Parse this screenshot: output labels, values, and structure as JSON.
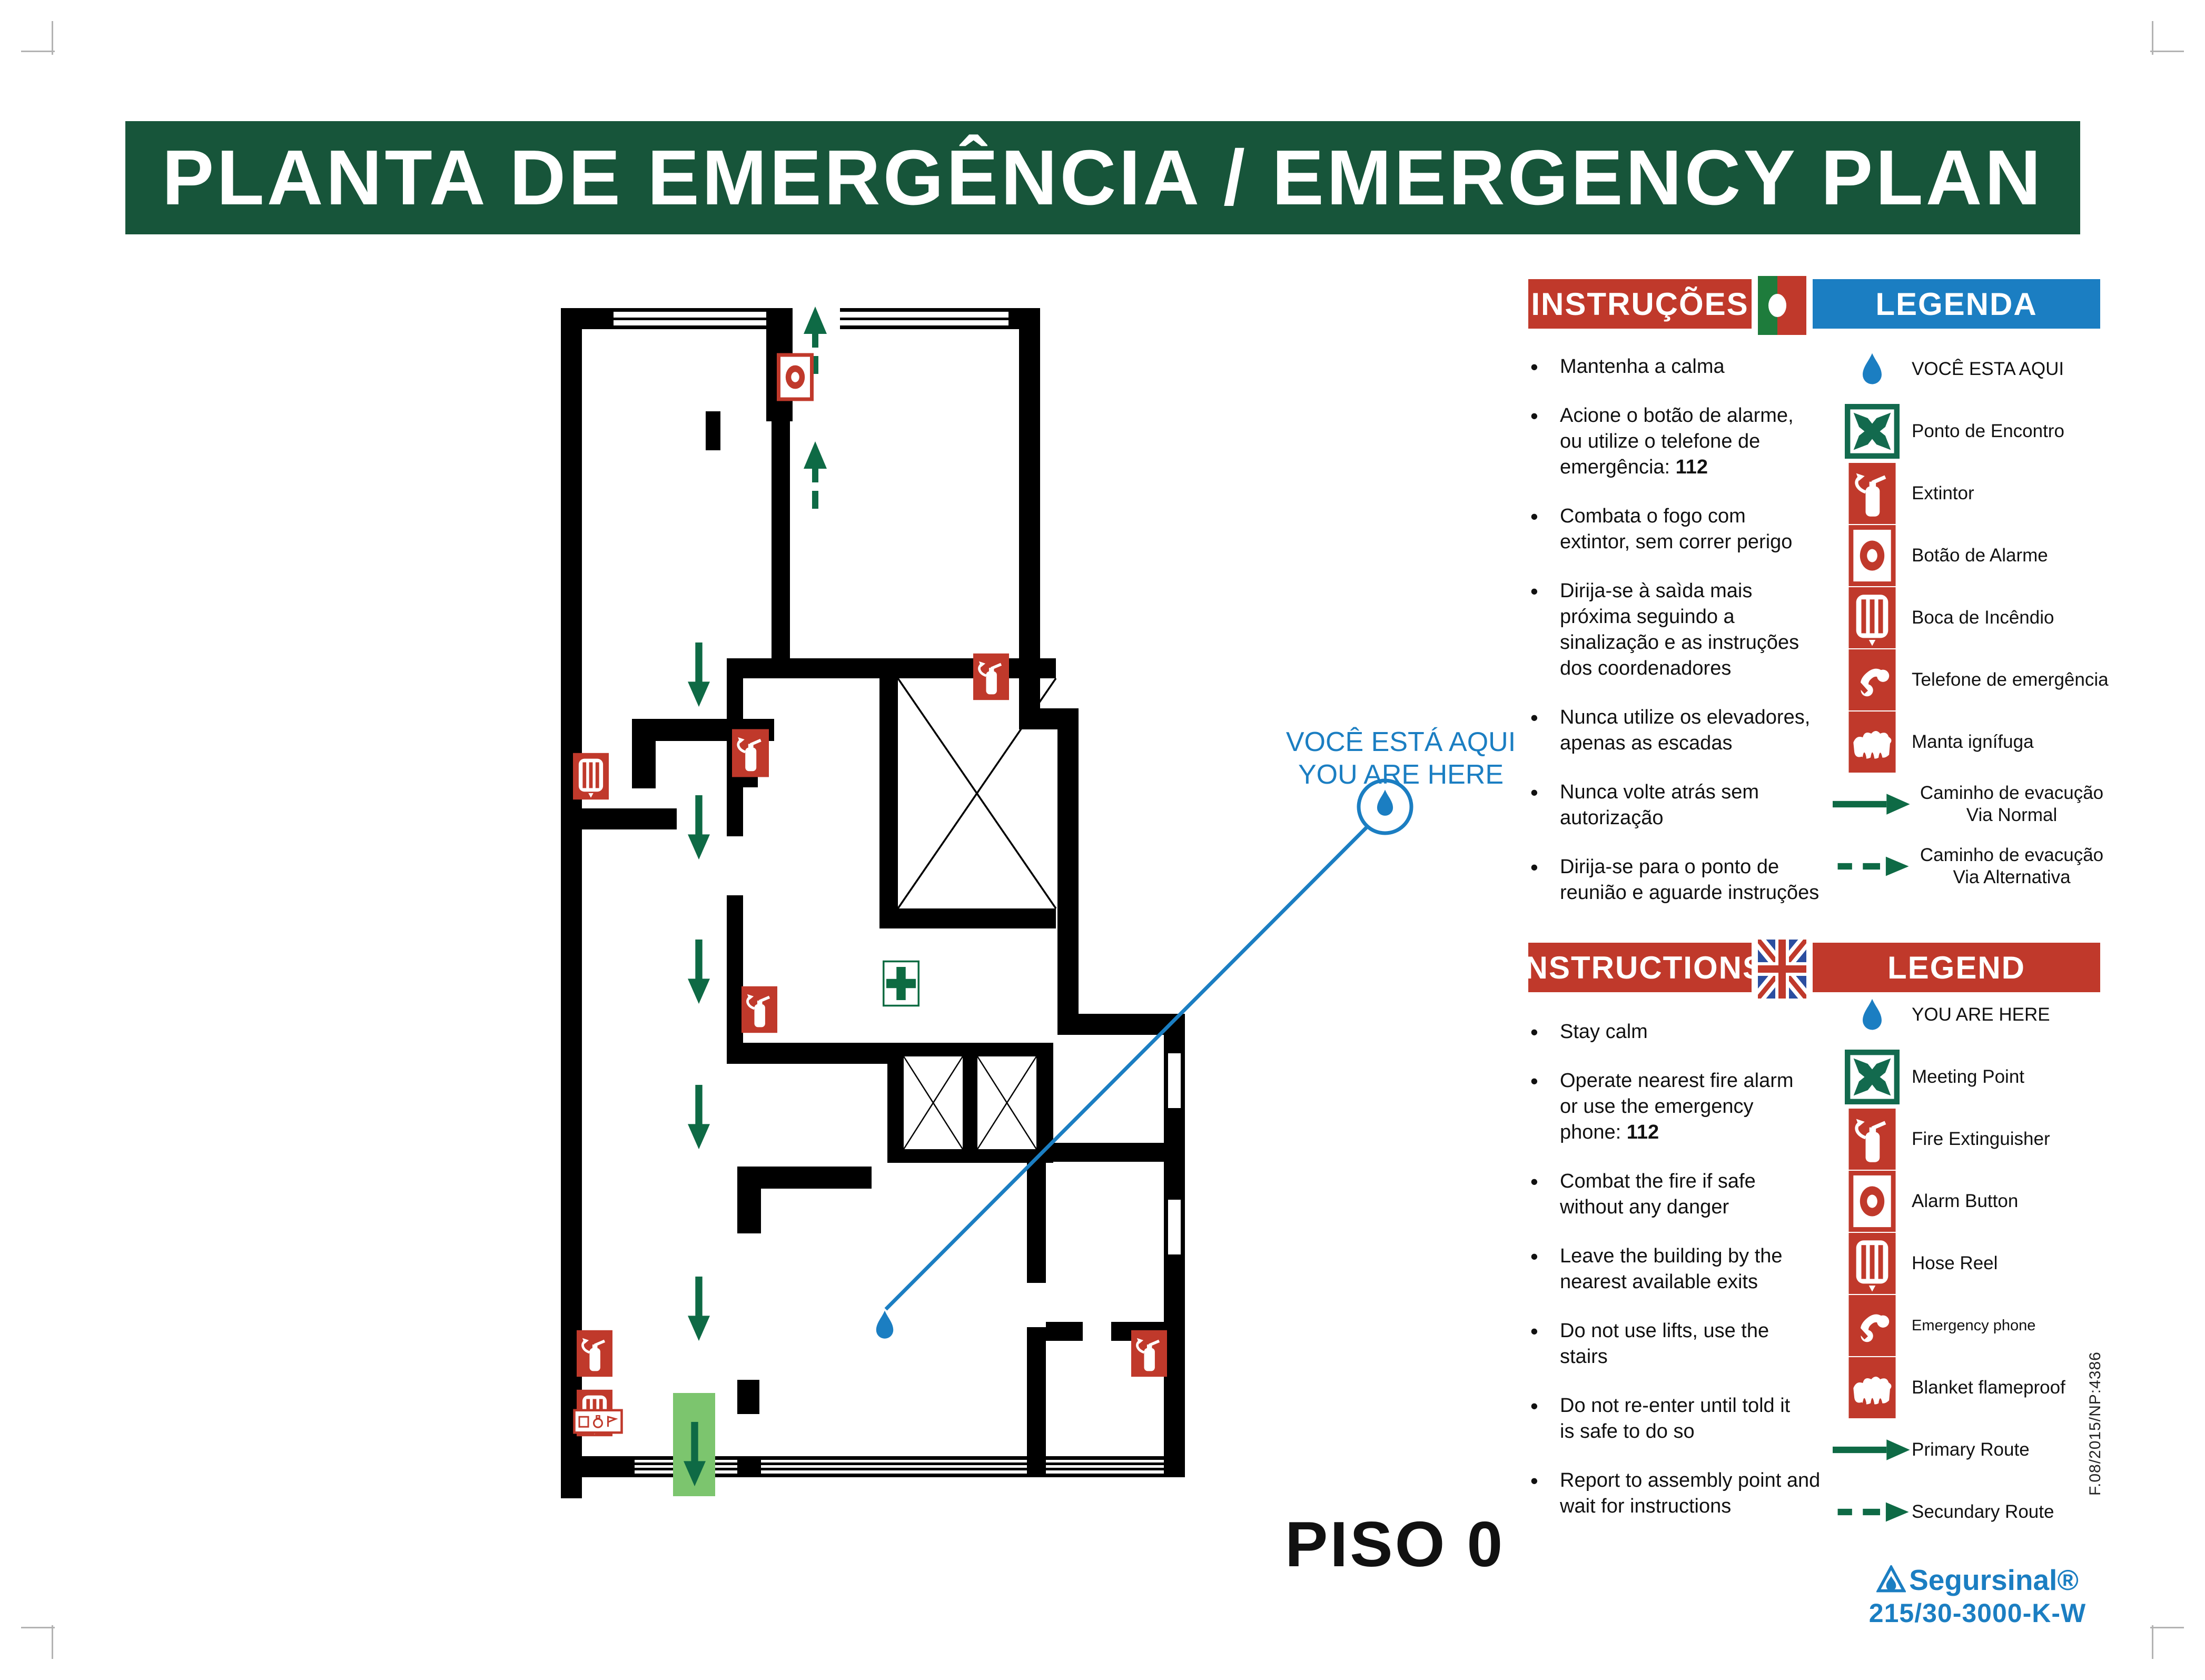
{
  "title": "PLANTA DE EMERGÊNCIA / EMERGENCY PLAN",
  "floor_label": "PISO 0",
  "emergency_number": "112",
  "callout": {
    "line1": "VOCÊ ESTÁ AQUI",
    "line2": "YOU ARE HERE"
  },
  "sections": {
    "pt": {
      "instructions_header": "INSTRUÇÕES",
      "legend_header": "LEGENDA",
      "flag": "portugal-flag",
      "instructions": [
        {
          "lines": [
            "Mantenha a calma"
          ]
        },
        {
          "lines": [
            "Acione o botão de alarme,",
            "ou utilize o telefone de",
            "emergência: 112"
          ]
        },
        {
          "lines": [
            "Combata o fogo com",
            "extintor, sem correr perigo"
          ]
        },
        {
          "lines": [
            "Dirija-se à saìda mais",
            "próxima seguindo a",
            "sinalização e as instruções",
            "dos coordenadores"
          ]
        },
        {
          "lines": [
            "Nunca utilize os elevadores,",
            "apenas as escadas"
          ]
        },
        {
          "lines": [
            "Nunca volte atrás sem",
            "autorização"
          ]
        },
        {
          "lines": [
            "Dirija-se para o ponto de",
            "reunião e aguarde instruções"
          ]
        }
      ],
      "legend": [
        {
          "icon": "droplet",
          "label": "VOCÊ ESTA AQUI"
        },
        {
          "icon": "meeting-point",
          "label": "Ponto de Encontro"
        },
        {
          "icon": "extinguisher",
          "label": "Extintor"
        },
        {
          "icon": "alarm-button",
          "label": "Botão de Alarme"
        },
        {
          "icon": "hose-reel",
          "label": "Boca de Incêndio"
        },
        {
          "icon": "emergency-phone",
          "label": "Telefone de emergência"
        },
        {
          "icon": "fire-blanket",
          "label": "Manta ignífuga"
        },
        {
          "icon": "arrow-solid",
          "label": "Caminho de evacução\nVia Normal",
          "center": true
        },
        {
          "icon": "arrow-dashed",
          "label": "Caminho de evacução\nVia Alternativa",
          "center": true
        }
      ]
    },
    "en": {
      "instructions_header": "INSTRUCTIONS",
      "legend_header": "LEGEND",
      "flag": "uk-flag",
      "instructions": [
        {
          "lines": [
            "Stay calm"
          ]
        },
        {
          "lines": [
            "Operate nearest fire alarm",
            "or use the emergency",
            "phone: 112"
          ]
        },
        {
          "lines": [
            "Combat the fire if safe",
            "without any danger"
          ]
        },
        {
          "lines": [
            "Leave the building by the",
            "nearest available exits"
          ]
        },
        {
          "lines": [
            "Do not use lifts, use the",
            "stairs"
          ]
        },
        {
          "lines": [
            "Do not re-enter until told it",
            "is safe to do so"
          ]
        },
        {
          "lines": [
            "Report to assembly point and",
            "wait for instructions"
          ]
        }
      ],
      "legend": [
        {
          "icon": "droplet",
          "label": "YOU ARE HERE"
        },
        {
          "icon": "meeting-point",
          "label": "Meeting Point"
        },
        {
          "icon": "extinguisher",
          "label": "Fire Extinguisher"
        },
        {
          "icon": "alarm-button",
          "label": "Alarm Button"
        },
        {
          "icon": "hose-reel",
          "label": "Hose Reel"
        },
        {
          "icon": "emergency-phone",
          "label": "Emergency phone",
          "small": true
        },
        {
          "icon": "fire-blanket",
          "label": "Blanket flameproof"
        },
        {
          "icon": "arrow-solid",
          "label": "Primary Route"
        },
        {
          "icon": "arrow-dashed",
          "label": "Secundary Route"
        }
      ]
    }
  },
  "branding": {
    "logo_text": "Segursinal®",
    "product_code": "215/30-3000-K-W",
    "doc_ref": "F.08/2015/NP:4386"
  },
  "colors": {
    "title_banner_green": "#17553A",
    "signal_red": "#C0392B",
    "accent_blue": "#1B7EC2",
    "route_green": "#0E6A45",
    "exit_green": "#7CC56E",
    "flag_green": "#1E7C3C",
    "uk_flag_blue": "#2B4EA0",
    "meeting_green": "#136A4E",
    "firstaid_green": "#0D6B42"
  }
}
